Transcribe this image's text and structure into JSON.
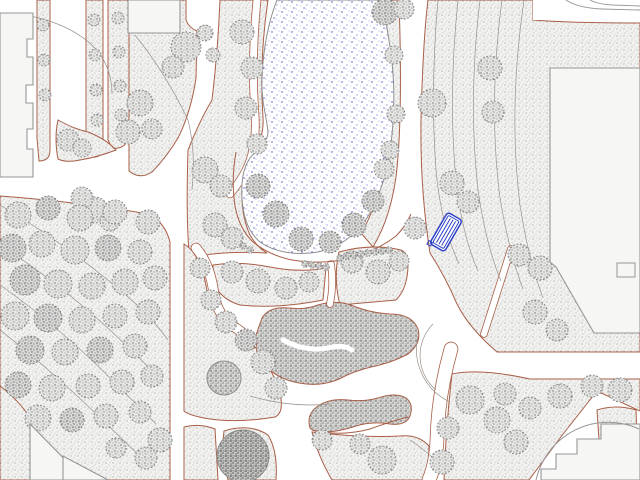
{
  "canvas": {
    "width": 640,
    "height": 480
  },
  "palette": {
    "bg": "#ffffff",
    "path_edge": "#a85f48",
    "grass_bg": "#f2f2f1",
    "grass_dot": "#9a9a9a",
    "tree_bg": "#e6e6e5",
    "tree_dot": "#6e6e6e",
    "treedark_bg": "#dcdcdb",
    "treedark_dot": "#565656",
    "bush_bg": "#d8d8d7",
    "bush_dot": "#4f4f4f",
    "dark_bg": "#c6c6c5",
    "dark_dot": "#3f3f3f",
    "pond_dot": "#3d49c9",
    "pond_dot2": "#6770d4",
    "pond_dot3": "#8890dd",
    "pond_stroke": "#8f8f8f",
    "building_fill": "#f6f6f5",
    "building_stroke": "#969696",
    "contour": "#9a9088",
    "tree_edge": "#7a7a7a",
    "bench_blue": "#2e41c7",
    "soft_stroke": "#8c8c8c"
  },
  "map": {
    "regions": [
      {
        "name": "hedge-strip-a",
        "d": "M37,0 L50,0 L50,150 Q50,161 39,161 L37,138 Z",
        "fill": "grass",
        "stroke": "red"
      },
      {
        "name": "hedge-strip-b",
        "d": "M86,0 L103,0 L103,146 Q103,158 92,157 L86,150 Z",
        "fill": "grass",
        "stroke": "red"
      },
      {
        "name": "hedge-strip-c",
        "d": "M108,0 L129,0 L129,136 Q126,150 112,148 L108,140 Z",
        "fill": "grass",
        "stroke": "red"
      },
      {
        "name": "corner-lawn",
        "d": "M58,120 Q74,129 88,132 Q106,139 116,150 Q98,157 80,160 Q66,163 58,159 Q54,138 58,120 Z",
        "fill": "grass",
        "stroke": "red"
      },
      {
        "name": "top-center-lawn",
        "d": "M129,0 L186,0 L186,20 Q189,28 197,31 L196,78 Q191,112 178,138 Q166,158 152,172 Q140,180 129,171 Z",
        "fill": "grass",
        "stroke": "red"
      },
      {
        "name": "pond-west-lawn",
        "d": "M220,0 L268,0 Q259,60 263,118 Q264,135 256,149 Q245,164 242,190 Q241,215 250,235 Q257,247 267,253 Q230,251 206,255 Q194,257 189,252 Q186,215 188,150 Q200,120 212,100 Q218,50 220,0 Z",
        "fill": "grass",
        "stroke": "red"
      },
      {
        "name": "pond-east-band",
        "d": "M381,0 L399,0 Q403,120 396,177 Q390,219 373,247 L361,233 Q379,205 385,152 Q389,80 381,0 Z",
        "fill": "grass",
        "stroke": "red"
      },
      {
        "name": "northeast-lawn",
        "d": "M428,0 L533,0 L533,20 Q570,23 640,23 L640,352 L497,352 Q469,328 457,304 Q445,276 430,253 Q420,190 421,120 Q423,40 428,0 Z",
        "fill": "grass",
        "stroke": "red"
      },
      {
        "name": "center-wedge-a",
        "d": "M213,265 Q240,261 270,267 Q300,273 326,268 L323,300 Q278,309 240,305 Q220,299 213,282 Z",
        "fill": "grass",
        "stroke": "red"
      },
      {
        "name": "center-wedge-b",
        "d": "M339,252 Q372,243 401,250 Q409,254 408,264 Q408,288 396,300 L340,305 Q333,278 339,252 Z",
        "fill": "grass",
        "stroke": "red"
      },
      {
        "name": "west-forest",
        "d": "M0,196 Q80,202 148,214 Q165,222 170,242 L170,480 L0,480 Z",
        "fill": "grass",
        "stroke": "red"
      },
      {
        "name": "mid-strip",
        "d": "M184,244 Q201,254 207,291 Q211,309 227,321 Q249,335 263,357 Q277,379 281,399 Q283,413 275,417 Q240,423 210,419 Q190,416 184,411 Z",
        "fill": "grass",
        "stroke": "red"
      },
      {
        "name": "patch-bottom-left",
        "d": "M184,427 Q200,423 215,429 L218,480 L184,480 Z",
        "fill": "grass",
        "stroke": "red"
      },
      {
        "name": "patch-bottom-center",
        "d": "M224,431 Q250,423 268,435 Q278,451 276,480 L228,480 Q221,454 224,431 Z",
        "fill": "grass",
        "stroke": "red"
      },
      {
        "name": "lawn-bottom-center",
        "d": "M312,432 Q360,438 400,436 Q418,434 429,446 L428,480 L332,480 Q318,456 312,432 Z",
        "fill": "grass",
        "stroke": "red"
      },
      {
        "name": "southeast-lawn",
        "d": "M452,374 Q480,368 530,379 L640,379 L640,411 L597,391 L560,438 L529,480 L444,480 Q446,425 452,374 Z",
        "fill": "grass",
        "stroke": "red"
      },
      {
        "name": "patch-southeast",
        "d": "M597,410 Q616,404 636,410 L637,442 Q614,446 599,440 Z",
        "fill": "grass",
        "stroke": "red"
      },
      {
        "name": "shrub-mass-main",
        "d": "M262,318 Q269,306 289,308 Q305,310 318,305 Q338,299 356,307 Q372,313 390,314 Q412,314 418,329 Q422,343 408,354 Q391,363 371,367 Q354,371 339,379 Q321,387 299,383 Q277,379 265,365 Q253,351 256,335 Z",
        "fill": "bush",
        "stroke": "red"
      },
      {
        "name": "shrub-ribbon",
        "d": "M310,428 Q306,414 318,406 Q330,398 348,400 Q364,402 378,398 Q396,392 406,398 Q414,404 410,416 Q406,426 390,424 Q372,421 356,426 Q338,432 324,432 Q314,432 310,428 Z",
        "fill": "bush",
        "stroke": "red"
      },
      {
        "name": "shrub-tree",
        "circle": [
          224,
          378,
          17
        ],
        "fill": "bush",
        "stroke": "soft"
      },
      {
        "name": "dense-tree",
        "circle": [
          243,
          456,
          26
        ],
        "fill": "dark",
        "stroke": "soft"
      }
    ],
    "thin_paths": [
      {
        "name": "pondside-walk-west",
        "d": "M257,0 Q251,60 255,115 Q257,148 246,170 Q240,182 230,194",
        "w": 7,
        "red": true
      },
      {
        "name": "diagonal-walk-ne",
        "d": "M511,249 L484,334",
        "w": 6,
        "red": true
      },
      {
        "name": "branch-walk",
        "d": "M331,264 Q334,284 330,304",
        "w": 6,
        "red": true
      },
      {
        "name": "center-diagonal-walk",
        "d": "M196,248 Q210,264 214,294 Q217,316 236,328 Q248,336 252,344",
        "w": 9,
        "red": true
      },
      {
        "name": "junction-south-walk",
        "d": "M451,349 Q438,395 437,440 Q436,463 429,480",
        "w": 13,
        "red": true
      },
      {
        "name": "shrub-gap",
        "d": "M283,340 Q305,352 328,348 Q344,344 352,350",
        "w": 5,
        "red": false
      }
    ],
    "red_lines": [
      "M236,152 Q231,180 235,206 Q239,228 252,241 Q268,255 292,260 Q322,265 352,258 Q378,250 396,236 Q406,226 411,214",
      "M0,386 Q16,398 26,412 Q31,419 30,424",
      "M312,430 Q340,437 370,429 Q392,421 408,417"
    ],
    "contours": [
      "M30,16 Q78,26 100,54 Q112,72 112,94",
      "M135,35 Q165,72 188,120 Q196,152 192,190",
      "M438,0 Q430,90 436,170 Q441,225 459,264",
      "M458,0 Q448,95 456,180 Q462,235 478,271",
      "M480,0 Q468,100 478,190 Q486,245 501,281",
      "M502,0 Q488,105 500,198 Q509,252 523,289",
      "M524,0 Q508,110 520,205 Q528,258 543,298",
      "M0,205 Q60,240 120,290 Q150,315 168,340",
      "M0,245 Q55,280 110,330 Q140,358 163,382",
      "M0,285 Q50,320 100,368 Q130,398 156,424",
      "M0,330 Q45,365 92,410 Q121,438 148,464",
      "M250,396 Q290,408 330,404",
      "M410,440 Q428,452 443,467",
      "M436,390 A45,45 0 0 1 433,324",
      "M450,402 A58,58 0 0 1 418,336"
    ],
    "pond": {
      "d": "M277,0 C269,20 263,48 262,78 C261,102 267,118 268,132 C268,142 258,148 250,158 C243,168 241,182 242,198 C243,216 248,232 260,242 C274,252 296,256 318,252 C338,248 355,236 367,218 C378,200 386,177 390,151 C394,123 395,91 392,62 C389,38 385,15 381,0 Z"
    },
    "trees": [
      [
        186,
        47,
        15,
        0
      ],
      [
        173,
        67,
        11,
        0
      ],
      [
        205,
        33,
        8,
        0
      ],
      [
        213,
        55,
        7,
        0
      ],
      [
        140,
        103,
        13,
        0
      ],
      [
        128,
        132,
        12,
        0
      ],
      [
        152,
        129,
        10,
        0
      ],
      [
        68,
        140,
        11,
        0
      ],
      [
        82,
        148,
        9,
        0
      ],
      [
        95,
        210,
        13,
        0
      ],
      [
        82,
        198,
        11,
        0
      ],
      [
        110,
        221,
        10,
        0
      ],
      [
        43,
        25,
        6,
        0
      ],
      [
        44,
        60,
        6,
        0
      ],
      [
        45,
        95,
        6,
        0
      ],
      [
        94,
        20,
        6,
        0
      ],
      [
        95,
        55,
        6,
        0
      ],
      [
        96,
        90,
        6,
        0
      ],
      [
        97,
        120,
        6,
        0
      ],
      [
        118,
        18,
        6,
        0
      ],
      [
        119,
        52,
        6,
        0
      ],
      [
        120,
        86,
        6,
        0
      ],
      [
        121,
        115,
        6,
        0
      ],
      [
        242,
        32,
        12,
        0
      ],
      [
        252,
        68,
        11,
        0
      ],
      [
        246,
        108,
        11,
        0
      ],
      [
        257,
        144,
        10,
        0
      ],
      [
        205,
        170,
        13,
        0
      ],
      [
        221,
        186,
        11,
        0
      ],
      [
        215,
        225,
        12,
        0
      ],
      [
        232,
        238,
        11,
        0
      ],
      [
        258,
        186,
        12,
        1
      ],
      [
        276,
        214,
        13,
        1
      ],
      [
        301,
        239,
        12,
        1
      ],
      [
        330,
        242,
        11,
        1
      ],
      [
        354,
        225,
        12,
        1
      ],
      [
        373,
        201,
        11,
        1
      ],
      [
        384,
        169,
        10,
        0
      ],
      [
        385,
        12,
        13,
        1
      ],
      [
        404,
        9,
        10,
        0
      ],
      [
        394,
        55,
        9,
        0
      ],
      [
        396,
        114,
        9,
        0
      ],
      [
        390,
        150,
        9,
        0
      ],
      [
        432,
        103,
        14,
        0
      ],
      [
        490,
        68,
        12,
        0
      ],
      [
        493,
        112,
        11,
        0
      ],
      [
        452,
        183,
        12,
        0
      ],
      [
        415,
        228,
        11,
        0
      ],
      [
        468,
        202,
        11,
        0
      ],
      [
        519,
        255,
        11,
        0
      ],
      [
        540,
        268,
        12,
        0
      ],
      [
        535,
        312,
        12,
        0
      ],
      [
        557,
        330,
        11,
        0
      ],
      [
        232,
        272,
        11,
        0
      ],
      [
        258,
        281,
        12,
        0
      ],
      [
        286,
        288,
        11,
        0
      ],
      [
        309,
        282,
        10,
        0
      ],
      [
        352,
        262,
        11,
        0
      ],
      [
        378,
        272,
        12,
        0
      ],
      [
        399,
        261,
        10,
        0
      ],
      [
        200,
        268,
        10,
        0
      ],
      [
        211,
        300,
        10,
        0
      ],
      [
        226,
        322,
        11,
        0
      ],
      [
        246,
        340,
        11,
        1
      ],
      [
        263,
        362,
        12,
        0
      ],
      [
        276,
        388,
        11,
        0
      ],
      [
        18,
        215,
        13,
        0
      ],
      [
        48,
        208,
        12,
        1
      ],
      [
        80,
        218,
        13,
        0
      ],
      [
        115,
        212,
        12,
        0
      ],
      [
        148,
        222,
        12,
        0
      ],
      [
        12,
        248,
        14,
        1
      ],
      [
        42,
        244,
        13,
        0
      ],
      [
        75,
        250,
        14,
        0
      ],
      [
        108,
        248,
        13,
        1
      ],
      [
        140,
        252,
        12,
        0
      ],
      [
        25,
        280,
        15,
        1
      ],
      [
        58,
        284,
        14,
        0
      ],
      [
        92,
        286,
        13,
        0
      ],
      [
        125,
        282,
        13,
        0
      ],
      [
        155,
        278,
        12,
        0
      ],
      [
        15,
        316,
        14,
        0
      ],
      [
        48,
        318,
        14,
        1
      ],
      [
        82,
        320,
        13,
        0
      ],
      [
        115,
        316,
        12,
        0
      ],
      [
        148,
        312,
        12,
        0
      ],
      [
        30,
        350,
        14,
        1
      ],
      [
        65,
        352,
        13,
        0
      ],
      [
        100,
        350,
        13,
        1
      ],
      [
        135,
        346,
        12,
        0
      ],
      [
        18,
        385,
        13,
        1
      ],
      [
        52,
        388,
        13,
        0
      ],
      [
        88,
        386,
        12,
        0
      ],
      [
        122,
        382,
        12,
        0
      ],
      [
        152,
        376,
        11,
        0
      ],
      [
        38,
        418,
        13,
        0
      ],
      [
        72,
        420,
        12,
        1
      ],
      [
        106,
        416,
        12,
        0
      ],
      [
        140,
        412,
        11,
        0
      ],
      [
        160,
        440,
        12,
        0
      ],
      [
        146,
        458,
        11,
        0
      ],
      [
        116,
        448,
        10,
        0
      ],
      [
        470,
        400,
        14,
        0
      ],
      [
        497,
        420,
        13,
        0
      ],
      [
        516,
        442,
        12,
        0
      ],
      [
        448,
        428,
        11,
        0
      ],
      [
        442,
        462,
        12,
        0
      ],
      [
        505,
        394,
        11,
        0
      ],
      [
        530,
        408,
        11,
        0
      ],
      [
        560,
        396,
        12,
        0
      ],
      [
        592,
        386,
        11,
        0
      ],
      [
        620,
        390,
        12,
        0
      ],
      [
        322,
        440,
        10,
        0
      ],
      [
        382,
        460,
        14,
        0
      ],
      [
        360,
        444,
        10,
        0
      ]
    ],
    "shrub_dots": [
      [
        305,
        264
      ],
      [
        312,
        265
      ],
      [
        319,
        266
      ],
      [
        326,
        267
      ],
      [
        340,
        258
      ],
      [
        347,
        256
      ],
      [
        354,
        255
      ],
      [
        361,
        254
      ],
      [
        368,
        253
      ],
      [
        375,
        252
      ],
      [
        382,
        251
      ],
      [
        389,
        250
      ],
      [
        243,
        246
      ],
      [
        250,
        250
      ]
    ],
    "buildings": [
      {
        "name": "building-top-left",
        "d": "M0,13 L33,13 L33,39 L27,39 L27,57 L33,57 L33,85 L26,85 L26,103 L33,103 L33,129 L27,129 L27,149 L33,149 L33,177 L0,177 Z",
        "kind": "solid"
      },
      {
        "name": "building-top-center",
        "d": "M128,0 L180,0 L180,33 L128,33 Z",
        "kind": "solid"
      },
      {
        "name": "road-strip-top-right",
        "d": "M533,0 L640,0 L640,21 Q570,20 533,20 Z",
        "kind": "white"
      },
      {
        "name": "building-right",
        "d": "M550,68 L640,68 L640,333 L594,333 L556,267 L550,262 Z",
        "kind": "solid"
      },
      {
        "name": "building-right-notch",
        "d": "M617,263 L635,263 L635,277 L617,277 Z",
        "kind": "line"
      },
      {
        "name": "building-bottom-left-a",
        "d": "M30,424 L30,480 L85,480 Z",
        "kind": "solid"
      },
      {
        "name": "building-bottom-left-b",
        "d": "M63,456 L63,480 L108,480 Z",
        "kind": "solid"
      },
      {
        "name": "building-bottom-right",
        "d": "M640,424 L601,424 L601,439 L577,439 L577,454 L556,454 L556,469 L541,469 L541,480 L640,480 Z",
        "kind": "solid"
      },
      {
        "name": "plaza-arc-bottom-right",
        "d": "M536,480 A74,74 0 0 1 639,429",
        "kind": "line"
      }
    ],
    "road_lines": [
      "M566,0 Q578,8 602,9 L640,10",
      "M590,0 Q597,4 612,5 L640,6"
    ],
    "bench": {
      "cx": 446,
      "cy": 232,
      "w": 17,
      "h": 36,
      "rot": 30,
      "rx": 3,
      "stripe_offsets": [
        -3,
        0,
        3
      ]
    }
  }
}
